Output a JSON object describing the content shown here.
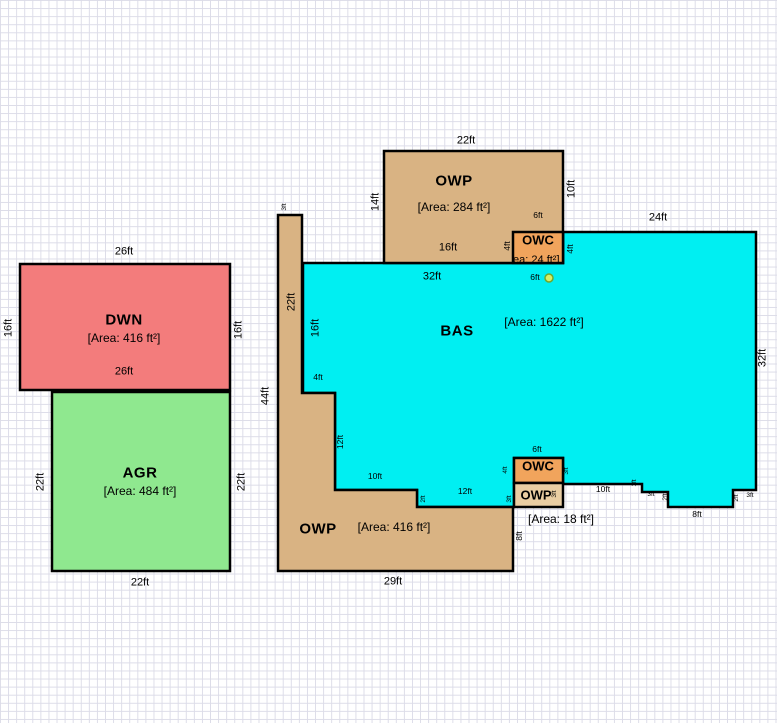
{
  "canvas": {
    "background": "#ffffff",
    "grid_color": "#dcdce8",
    "outline_color": "#000000"
  },
  "areas": {
    "dwn": {
      "code": "DWN",
      "area": "[Area: 416 ft²]",
      "fill": "#f37c7c"
    },
    "agr": {
      "code": "AGR",
      "area": "[Area: 484 ft²]",
      "fill": "#8fe88f"
    },
    "owp_top": {
      "code": "OWP",
      "area": "[Area: 284 ft²]",
      "fill": "#d9b383"
    },
    "owc_top": {
      "code": "OWC",
      "area": "[Area: 24 ft²]",
      "fill": "#f1a45c"
    },
    "bas": {
      "code": "BAS",
      "area": "[Area: 1622 ft²]",
      "fill": "#00eff2"
    },
    "owp_bottom": {
      "code": "OWP",
      "area": "[Area: 416 ft²]",
      "fill": "#d9b383"
    },
    "owc_bottom": {
      "code": "OWC",
      "fill": "#f1a45c"
    },
    "owp_small": {
      "code": "OWP",
      "area": "[Area: 18 ft²]",
      "fill": "#e9cda2"
    }
  },
  "marker": {
    "fill": "#d6ef67",
    "ring": "#6fa82c"
  },
  "dims": {
    "dwn_top": "26ft",
    "dwn_left": "16ft",
    "dwn_right": "16ft",
    "dwn_bottom": "26ft",
    "agr_left": "22ft",
    "agr_right": "22ft",
    "agr_bottom": "22ft",
    "owp_top_top": "22ft",
    "owp_top_left": "14ft",
    "owp_top_right": "10ft",
    "owp_top_bottom": "16ft",
    "owc_top_width": "6ft",
    "owc_top_left": "4ft",
    "owc_top_right": "4ft",
    "bas_top_left_seg": "32ft",
    "bas_marker": "6ft",
    "bas_top_right_seg": "24ft",
    "bas_right": "32ft",
    "bas_left": "16ft",
    "col_width": "3ft",
    "col_height": "22ft",
    "owp_bottom_height": "44ft",
    "step_4ft": "4ft",
    "step_12ft": "12ft",
    "step_10ft": "10ft",
    "step_2ft": "2ft",
    "bas_bottom_12ft": "12ft",
    "owc_bottom_width": "6ft",
    "owc_bottom_left": "4ft",
    "owc_bottom_right": "3ft",
    "owp_small_left": "3ft",
    "owp_small_right": "3ft",
    "bas_bottom_10ft": "10ft",
    "bas_step_1ft": "1ft",
    "bas_step_3ft_a": "3ft",
    "bas_step_2ft_a": "2ft",
    "bas_step_2ft_b": "2ft",
    "bas_step_3ft_b": "3ft",
    "bas_bottom_8ft": "8ft",
    "owp_bottom_bottom": "29ft",
    "owp_bottom_right": "8ft"
  }
}
